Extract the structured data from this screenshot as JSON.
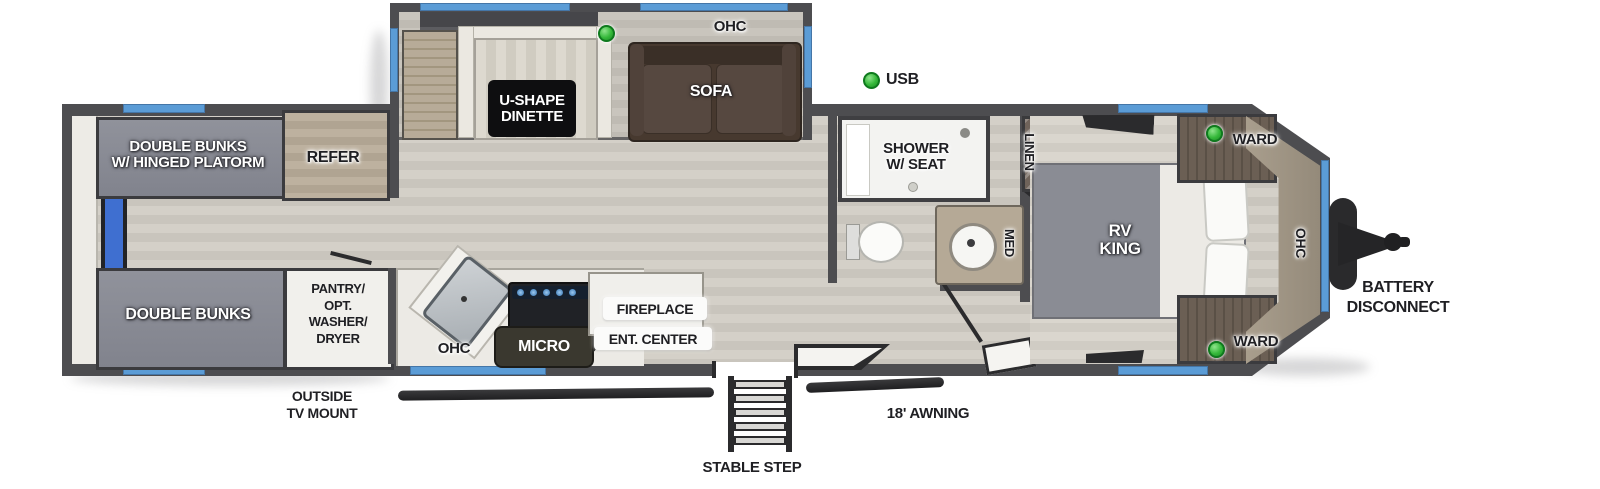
{
  "title": "Travel trailer floor plan",
  "colors": {
    "wall": "#4d4d50",
    "window_blue": "#5b9cd6",
    "floor_light": "#d4d0c8",
    "floor_dark": "#c9c5bd",
    "accent_green": "#35b83a",
    "bunk_gray": "#8a8c96",
    "cabinet_tan": "#b5a996",
    "sofa_brown": "#47392f",
    "hardware_dark": "#2b2b2d",
    "interior_white": "#f1f0ec"
  },
  "labels": {
    "bunk_top": [
      "DOUBLE BUNKS",
      "W/ HINGED PLATORM"
    ],
    "refer": "REFER",
    "dinette": [
      "U-SHAPE",
      "DINETTE"
    ],
    "ohc_dinette": "OHC",
    "sofa": "SOFA",
    "usb": "USB",
    "shower": [
      "SHOWER",
      "W/ SEAT"
    ],
    "linen": "LINEN",
    "med": "MED",
    "rv_king": [
      "RV",
      "KING"
    ],
    "ward_top": "WARD",
    "ward_bottom": "WARD",
    "ohc_bedroom": "OHC",
    "battery": [
      "BATTERY",
      "DISCONNECT"
    ],
    "bunk_bottom": "DOUBLE BUNKS",
    "pantry": [
      "PANTRY/",
      "OPT.",
      "WASHER/",
      "DRYER"
    ],
    "outside_tv": [
      "OUTSIDE",
      "TV MOUNT"
    ],
    "ohc_kitchen": "OHC",
    "micro": "MICRO",
    "fireplace": "FIREPLACE",
    "ent_center": "ENT. CENTER",
    "stable_step": "STABLE STEP",
    "awning": "18' AWNING"
  }
}
